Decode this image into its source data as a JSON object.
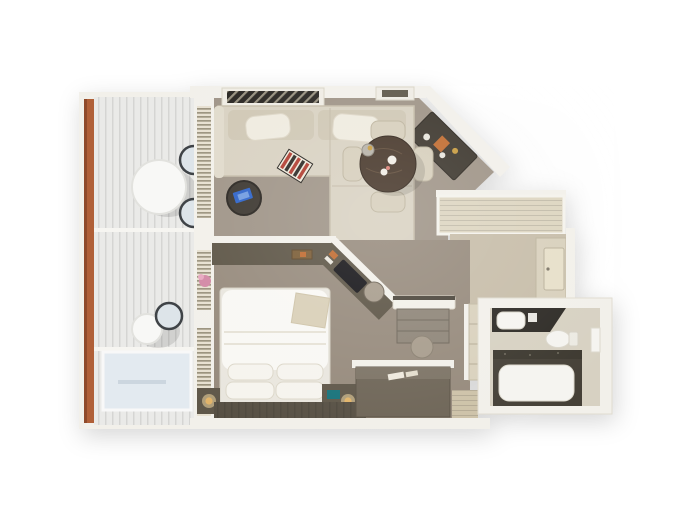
{
  "scene": {
    "kind": "3d-floorplan-render",
    "rooms": [
      {
        "name": "balcony",
        "features": [
          "wood railing",
          "two round tables",
          "three chairs",
          "glass screen"
        ]
      },
      {
        "name": "living-dining-room",
        "features": [
          "sectional sofa",
          "backgammon board",
          "coffee table",
          "round dining table",
          "four chairs",
          "minibar"
        ]
      },
      {
        "name": "bedroom",
        "features": [
          "double bed",
          "four pillows",
          "two nightstands",
          "lamps",
          "tv console",
          "desk with stool"
        ]
      },
      {
        "name": "entry-hall",
        "features": [
          "credenza",
          "closet",
          "entry door"
        ]
      },
      {
        "name": "bathroom",
        "features": [
          "vanity counter",
          "sink",
          "toilet",
          "bathtub",
          "towel shelf"
        ]
      },
      {
        "name": "walk-in-closet",
        "features": [
          "dark wardrobe",
          "wood floor"
        ]
      }
    ]
  },
  "palette": {
    "background": "#ffffff",
    "wall": "#f2f0ea",
    "wall_edge": "#e1ddd1",
    "balcony_wood": "#b06038",
    "balcony_wood_dark": "#8f4a2a",
    "deck": "#eaeae8",
    "glass": "#e3eaf0",
    "chair_metal": "#dde4e9",
    "chair_rim": "#3f4347",
    "outdoor_table": "#f8f8f6",
    "blinds": "#e7e0d0",
    "flower_pink": "#d288a4",
    "carpet_living": "#9e9386",
    "carpet_bedroom": "#968a7c",
    "sofa": "#d8d1c1",
    "sofa_back": "#cfc7b4",
    "pillow_cream": "#efebdf",
    "coffee_table": "#3a352e",
    "accent_blue": "#2b62c9",
    "accent_red": "#b03a2e",
    "dining_wood": "#453528",
    "chair_cream": "#d6cebb",
    "grille_dark": "#26231f",
    "minibar_dark": "#3b352c",
    "accent_orange": "#c06a2e",
    "gold": "#c79a3d",
    "credenza": "#ddd5c0",
    "entry_floor": "#c7bda9",
    "closet_door": "#e7dfc9",
    "closet_panel": "#d8d0bc",
    "console_dark": "#5c5445",
    "tv_black": "#141317",
    "desk_cabinet": "#8e8578",
    "stool": "#a79c8c",
    "bed_frame": "#e9e6de",
    "bed_white": "#f9f8f4",
    "pillow_white": "#f6f4ee",
    "throw_beige": "#d9cfb7",
    "nightstand": "#5f5749",
    "teal_accent": "#17727a",
    "lamp_gold": "#e2b469",
    "dark_plank": "#575044",
    "wardrobe_dark": "#6e6557",
    "wardrobe_top": "#7c7365",
    "wood_floor": "#cdc2a8",
    "dresser": "#d9d1bd",
    "bath_floor": "#d7d1c2",
    "counter_dark": "#2d2a25",
    "fixture_white": "#f5f4f0",
    "tub_surround": "#454037",
    "tile_band": "#3c382f"
  }
}
